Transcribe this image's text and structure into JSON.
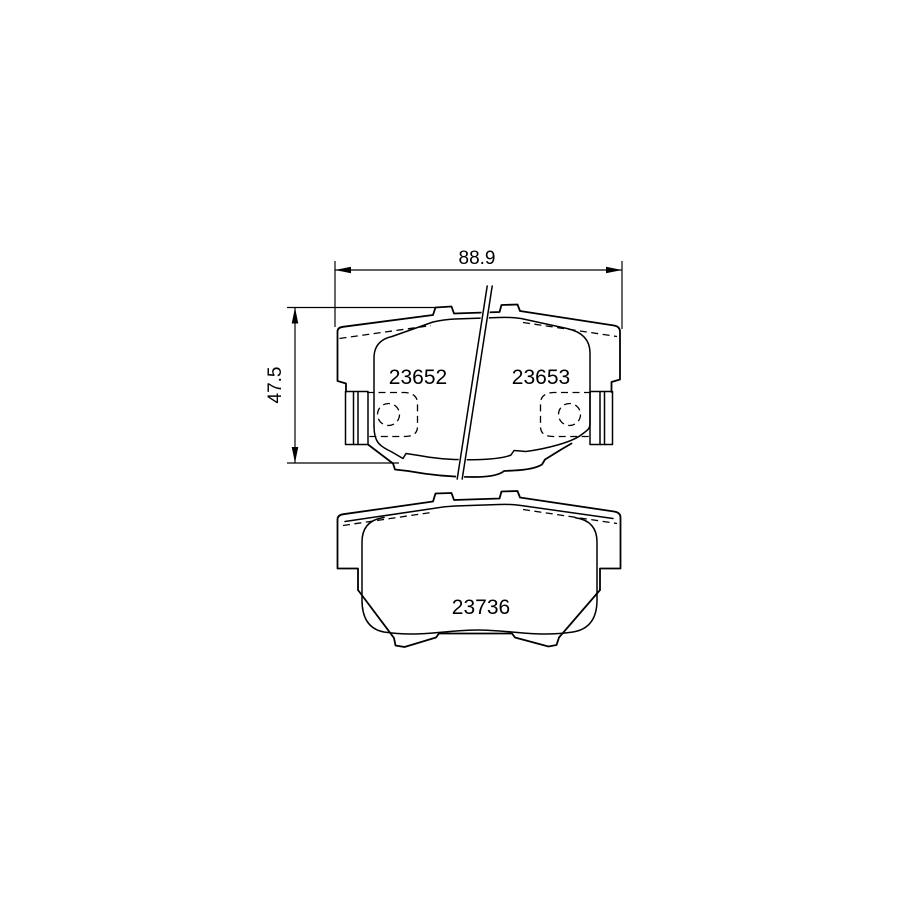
{
  "drawing": {
    "type": "brake-pad-technical-drawing",
    "background": "#ffffff",
    "line_color": "#000000",
    "dimensions": {
      "width_label": "88.9",
      "height_label": "47.5"
    },
    "front_view": {
      "left_part_number": "23652",
      "right_part_number": "23653"
    },
    "back_view": {
      "part_number": "23736"
    }
  }
}
